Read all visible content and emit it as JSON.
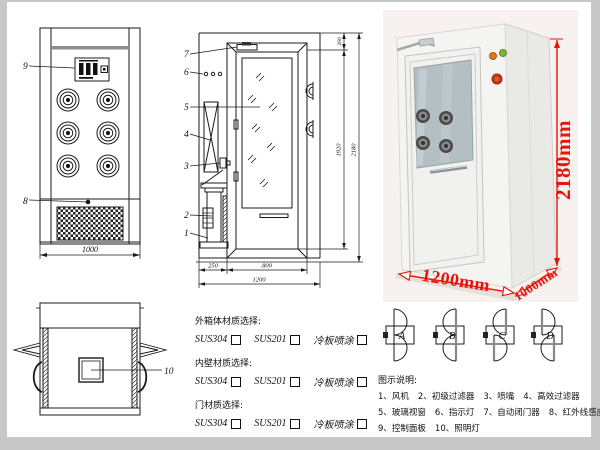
{
  "page": {
    "background": "#ffffff",
    "frame_color": "#c7c7c7"
  },
  "front_view": {
    "callout_panel": "9",
    "callout_grille": "8",
    "dim_width": "1000"
  },
  "section_view": {
    "callouts": {
      "c1": "1",
      "c2": "2",
      "c3": "3",
      "c4": "4",
      "c5": "5",
      "c6": "6",
      "c7": "7"
    },
    "dims": {
      "top": "260",
      "door_height": "1920",
      "total_height": "2180",
      "left": "250",
      "door_width": "800",
      "total_width": "1200"
    }
  },
  "top_view": {
    "callout_lamp": "10"
  },
  "photo": {
    "dim_height": "2180mm",
    "dim_width": "1200mm",
    "dim_depth": "1000mm"
  },
  "materials": {
    "groups": [
      {
        "title": "外箱体材质选择:",
        "options": [
          "SUS304",
          "SUS201",
          "冷板喷涂"
        ]
      },
      {
        "title": "内壁材质选择:",
        "options": [
          "SUS304",
          "SUS201",
          "冷板喷涂"
        ]
      },
      {
        "title": "门材质选择:",
        "options": [
          "SUS304",
          "SUS201",
          "冷板喷涂"
        ]
      }
    ]
  },
  "door_configs": {
    "a": "A",
    "b": "B",
    "c": "C",
    "d": "D"
  },
  "legend": {
    "title": "图示说明:",
    "rows": [
      [
        "1、风机",
        "2、初级过滤器",
        "3、喷嘴",
        "4、高效过滤器"
      ],
      [
        "5、玻璃视窗",
        "6、指示灯",
        "7、自动闭门器",
        "8、红外线感应器"
      ],
      [
        "9、控制面板",
        "10、照明灯"
      ]
    ]
  },
  "colors": {
    "dim_red": "#e8140c",
    "line": "#1a1a1a"
  }
}
